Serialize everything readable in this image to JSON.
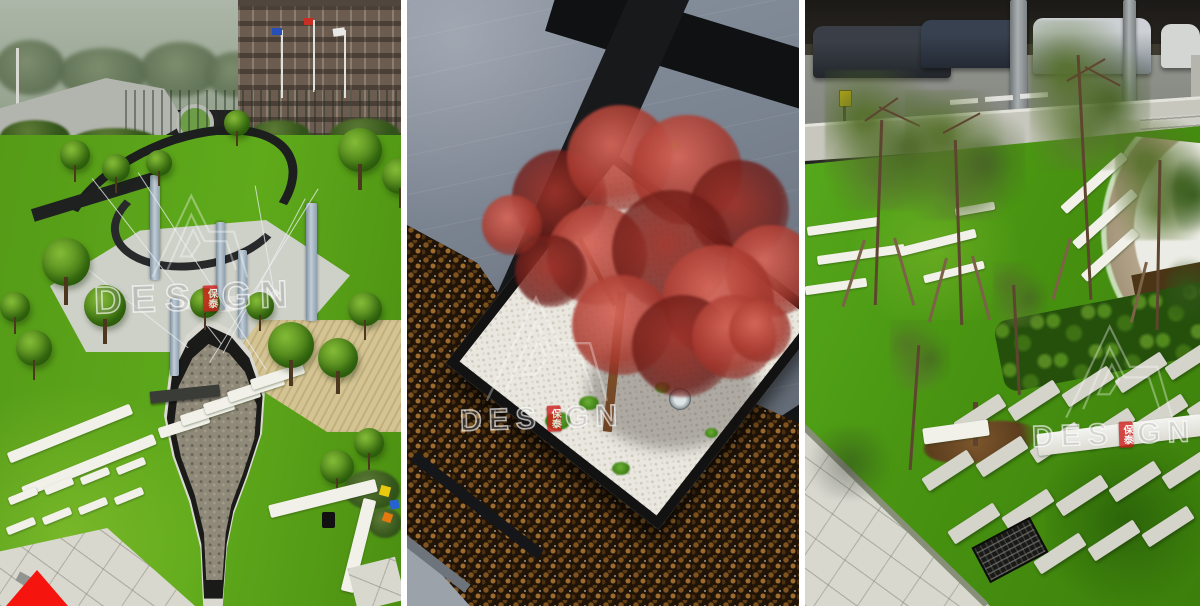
{
  "image_type": "landscape-architecture photo collage, three vertical photos",
  "panels": {
    "left": {
      "description": "Aerial view of a corporate plaza garden with spiral stone wall, steel masts with cables, leaf-shaped dry stream crossed by white slabs, lawns with stepping strips, road, flags and brick building beyond"
    },
    "middle": {
      "description": "Overhead view of a red Japanese maple in a white-gravel square planter with black granite edge, set in a field of brown river pebbles beside grey stone paving with black bands"
    },
    "right": {
      "description": "Vivid lawn with staked young trees, rows of stepping-stone slabs, white stone strips, clipped hedge, gravel-edged white path, paved walk with drain grate, and a parking lot with cars under a dark canopy"
    }
  },
  "watermark": {
    "prefix": "DES",
    "suffix": "GN",
    "full_text": "DESIGN",
    "seal_characters": "保泰",
    "seal_color": "#c4201e",
    "logo": "triangle-A-monogram outline"
  },
  "corner_marker": {
    "shape": "triangle",
    "color": "#e91812"
  },
  "colors": {
    "grass": "#4f9420",
    "maple_red": "#b34a44",
    "pebbles": "#241708",
    "gravel_white": "#eae8e1",
    "stone_dark": "#141618",
    "paving_light": "#d6d6cf",
    "gap": "#ffffff"
  }
}
